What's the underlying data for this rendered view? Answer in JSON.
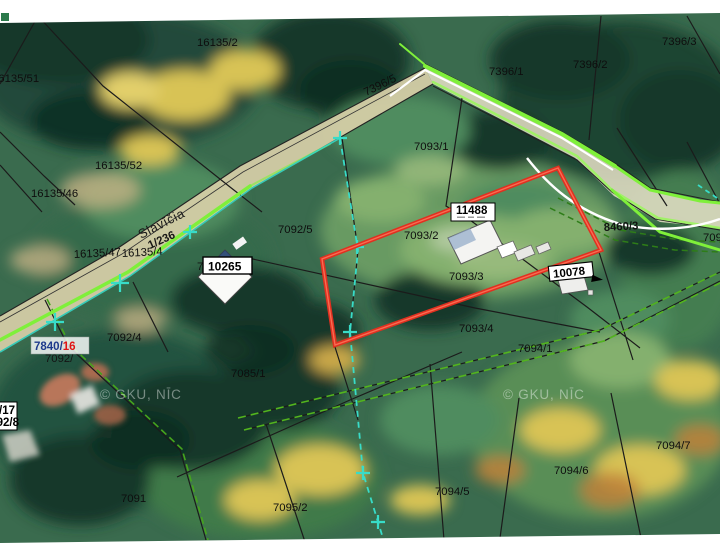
{
  "map": {
    "road_name": "Slavīčia",
    "watermark": "© GKU, NĪC",
    "colors": {
      "selection_outline_red": "#f23b26",
      "survey_line_cyan": "#38dcc8",
      "route_line_lime": "#7ff03a",
      "boundary_dash_green": "#46a41d",
      "road_fill_tan": "#d8cfa8",
      "building_label_navy": "#1d3a8c",
      "building_label_red": "#e01414"
    },
    "parcel_labels": [
      "16135/2",
      "7396/1",
      "7396/2",
      "7396/3",
      "16135/51",
      "16135/52",
      "16135/46",
      "16135/47",
      "16135/4",
      "7093/1",
      "7092/5",
      "7093/2",
      "7093/3",
      "7093/4",
      "7094/1",
      "7092/4",
      "7085/1",
      "7091",
      "7095/2",
      "7094/5",
      "7094/6",
      "7094/7",
      "709",
      "7092/",
      "7092/6"
    ],
    "green_labels": [
      "8460/3",
      "7396/5",
      "1/236"
    ],
    "building_labels": [
      "11488",
      "10265",
      "10078"
    ],
    "address_label": {
      "parcel_part": "7840/",
      "house_part": "16"
    },
    "edge_labels": {
      "top_line": "7840/17",
      "bottom_line": "7092/8"
    }
  }
}
